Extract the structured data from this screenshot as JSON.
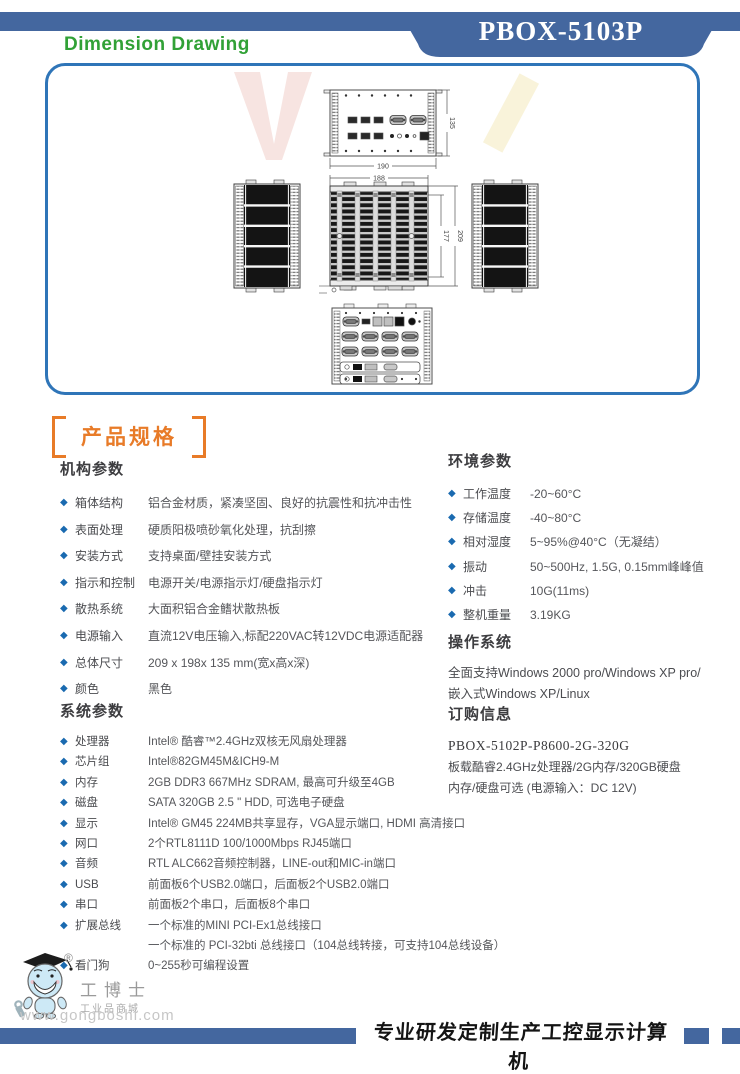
{
  "header": {
    "model_badge": "PBOX-5103P",
    "page_title": "Dimension Drawing"
  },
  "drawing": {
    "dims": {
      "top_width": "190",
      "depth": "135",
      "front_width": "188",
      "inner_height": "177",
      "height": "209"
    }
  },
  "sections": {
    "product_spec_title": "产品规格",
    "mech": {
      "title": "机构参数",
      "items": [
        {
          "label": "箱体结构",
          "value": "铝合金材质，紧凑坚固、良好的抗震性和抗冲击性"
        },
        {
          "label": "表面处理",
          "value": "硬质阳极喷砂氧化处理，抗刮擦"
        },
        {
          "label": "安装方式",
          "value": "支持桌面/壁挂安装方式"
        },
        {
          "label": "指示和控制",
          "value": "电源开关/电源指示灯/硬盘指示灯"
        },
        {
          "label": "散热系统",
          "value": "大面积铝合金鳍状散热板"
        },
        {
          "label": "电源输入",
          "value": "直流12V电压输入,标配220VAC转12VDC电源适配器"
        },
        {
          "label": "总体尺寸",
          "value": "209 x 198x 135 mm(宽x高x深)"
        },
        {
          "label": "颜色",
          "value": "黑色"
        }
      ]
    },
    "sys": {
      "title": "系统参数",
      "items": [
        {
          "label": "处理器",
          "value": "Intel® 酷睿™2.4GHz双核无风扇处理器"
        },
        {
          "label": "芯片组",
          "value": "Intel®82GM45M&ICH9-M"
        },
        {
          "label": "内存",
          "value": "2GB DDR3  667MHz SDRAM, 最高可升级至4GB"
        },
        {
          "label": "磁盘",
          "value": "SATA 320GB 2.5 \" HDD, 可选电子硬盘"
        },
        {
          "label": "显示",
          "value": "Intel® GM45 224MB共享显存，VGA显示端口, HDMI 高清接口"
        },
        {
          "label": "网口",
          "value": "2个RTL8111D 100/1000Mbps RJ45端口"
        },
        {
          "label": "音频",
          "value": "RTL ALC662音频控制器，LINE-out和MIC-in端口"
        },
        {
          "label": "USB",
          "value": "前面板6个USB2.0端口，后面板2个USB2.0端口"
        },
        {
          "label": "串口",
          "value": "前面板2个串口，后面板8个串口"
        },
        {
          "label": "扩展总线",
          "value": "一个标准的MINI PCI-Ex1总线接口",
          "value2": "一个标准的 PCI-32bti 总线接口（104总线转接，可支持104总线设备）"
        },
        {
          "label": "看门狗",
          "value": "0~255秒可编程设置"
        }
      ]
    },
    "env": {
      "title": "环境参数",
      "items": [
        {
          "label": "工作温度",
          "value": "-20~60°C"
        },
        {
          "label": "存储温度",
          "value": "-40~80°C"
        },
        {
          "label": "相对湿度",
          "value": "5~95%@40°C（无凝结）"
        },
        {
          "label": "振动",
          "value": "50~500Hz, 1.5G, 0.15mm峰峰值"
        },
        {
          "label": "冲击",
          "value": "10G(11ms)"
        },
        {
          "label": "整机重量",
          "value": "3.19KG"
        }
      ]
    },
    "os": {
      "title": "操作系统",
      "lines": [
        "全面支持Windows 2000 pro/Windows XP pro/",
        "嵌入式Windows XP/Linux"
      ]
    },
    "order": {
      "title": "订购信息",
      "model": "PBOX-5102P-P8600-2G-320G",
      "lines": [
        "板载酷睿2.4GHz处理器/2G内存/320GB硬盘",
        "内存/硬盘可选 (电源输入：DC 12V)"
      ]
    }
  },
  "footer": {
    "registered_mark": "®",
    "brand_name": "工博士",
    "brand_sub": "工业品商城",
    "brand_url": "www.gongboshi.com",
    "slogan": "专业研发定制生产工控显示计算机"
  },
  "colors": {
    "brand_blue": "#44679f",
    "panel_border_blue": "#2f75b8",
    "title_green": "#31a136",
    "accent_orange": "#e87b28",
    "bullet_blue": "#1a6ab0",
    "body_text": "#55565a"
  }
}
